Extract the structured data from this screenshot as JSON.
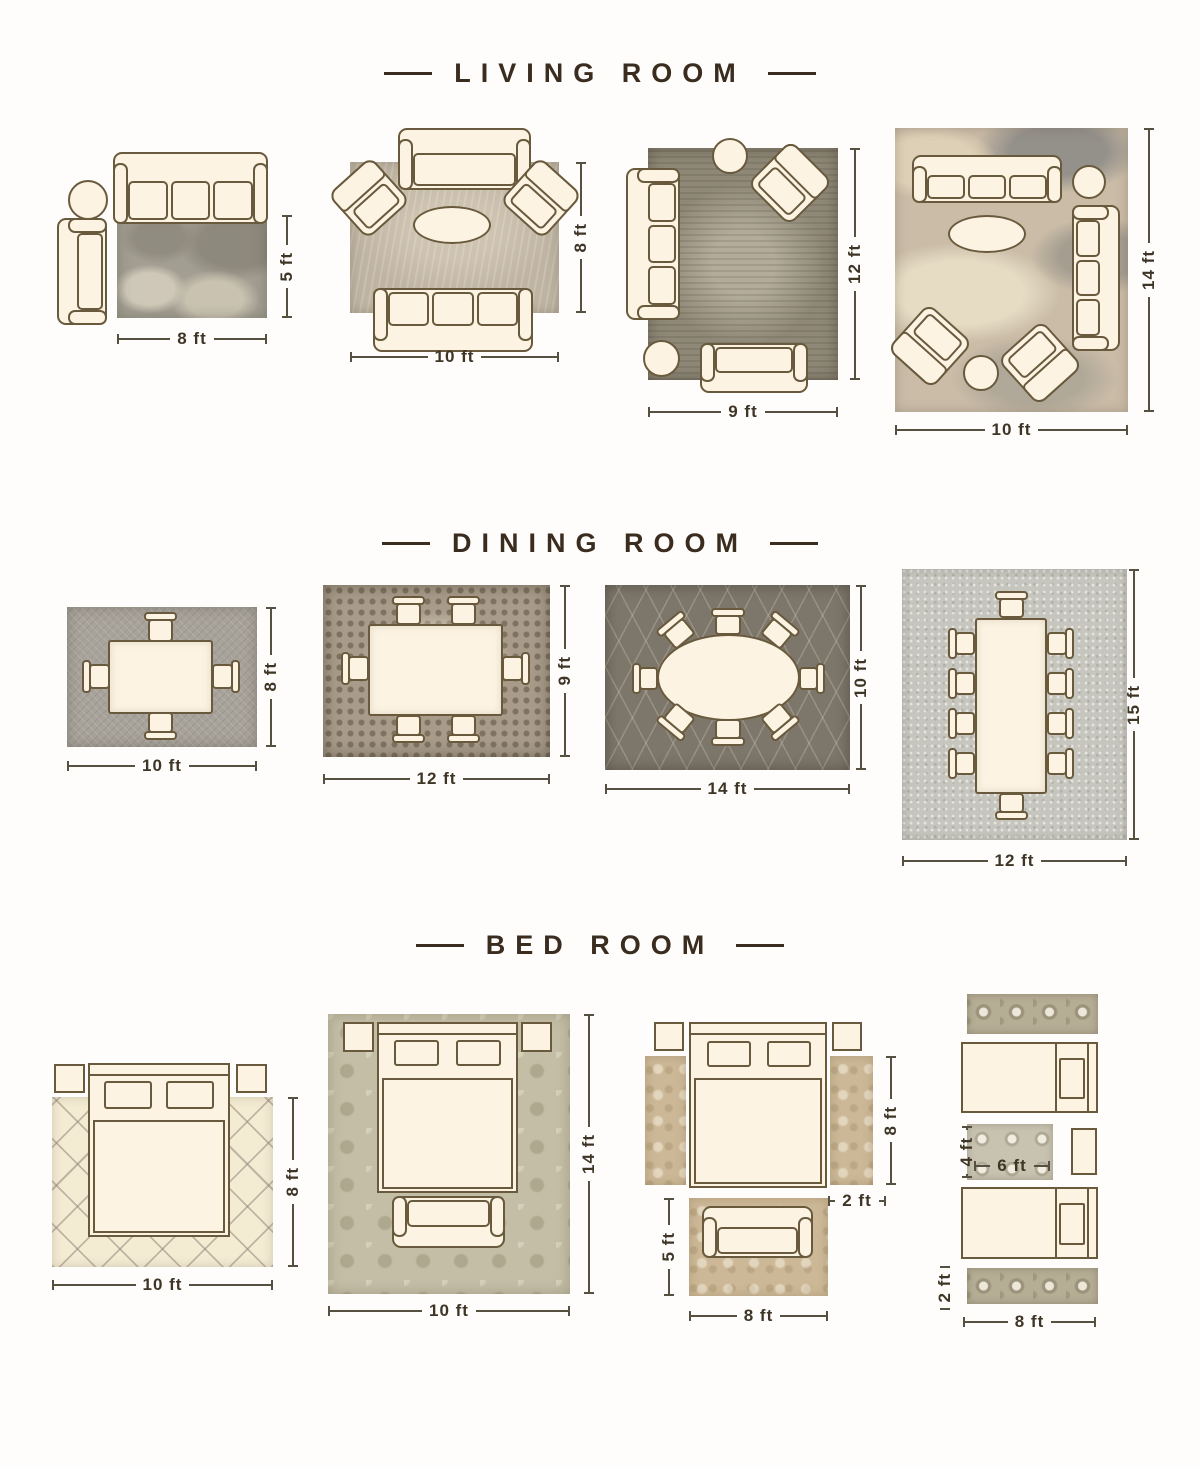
{
  "colors": {
    "header_text": "#3a2c1e",
    "furniture_outline": "#6a5a3d",
    "furniture_fill": "#fcf3e3",
    "dimension_text": "#3e3526"
  },
  "sections": {
    "living": {
      "title": "LIVING ROOM",
      "layouts": {
        "l1": {
          "width": "8 ft",
          "height": "5 ft"
        },
        "l2": {
          "width": "10 ft",
          "height": "8 ft"
        },
        "l3": {
          "width": "9 ft",
          "height": "12 ft"
        },
        "l4": {
          "width": "10 ft",
          "height": "14 ft"
        }
      }
    },
    "dining": {
      "title": "DINING ROOM",
      "layouts": {
        "d1": {
          "width": "10 ft",
          "height": "8 ft"
        },
        "d2": {
          "width": "12 ft",
          "height": "9 ft"
        },
        "d3": {
          "width": "14 ft",
          "height": "10 ft"
        },
        "d4": {
          "width": "12 ft",
          "height": "15 ft"
        }
      }
    },
    "bedroom": {
      "title": "BED ROOM",
      "layouts": {
        "b1": {
          "width": "10 ft",
          "height": "8 ft"
        },
        "b2": {
          "width": "10 ft",
          "height": "14 ft"
        },
        "b3": {
          "runner_height": "8 ft",
          "runner_width": "2 ft",
          "rug_height": "5 ft",
          "rug_width": "8 ft"
        },
        "b4": {
          "accent_rug_height": "4 ft",
          "accent_rug_width": "6 ft",
          "runner_height": "2 ft",
          "runner_width": "8 ft"
        }
      }
    }
  }
}
